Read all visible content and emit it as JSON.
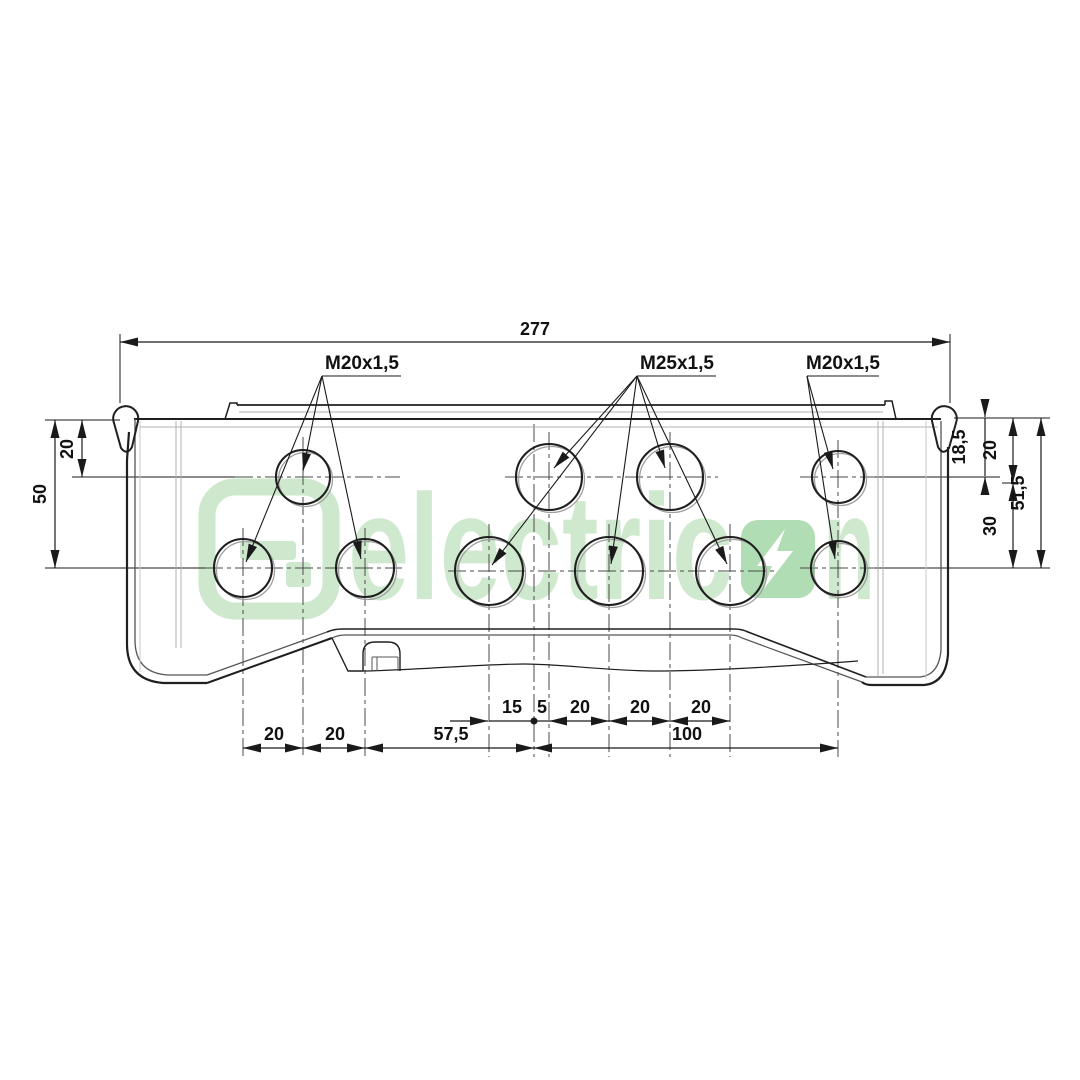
{
  "drawing": {
    "overall_width_dim": "277",
    "thread_labels": {
      "left": "M20x1,5",
      "middle": "M25x1,5",
      "right": "M20x1,5"
    },
    "left_dims": [
      "20",
      "50"
    ],
    "right_dims": [
      "18,5",
      "20",
      "30",
      "51,5"
    ],
    "bottom_upper": [
      "15",
      "5",
      "20",
      "20",
      "20"
    ],
    "bottom_lower": [
      "20",
      "20",
      "57,5",
      "100"
    ]
  },
  "watermark": {
    "word": "electric",
    "suffix": "n",
    "logo": "g-mark-logo",
    "bolt_icon": "lightning-bolt",
    "word_color": "#cfe9cf",
    "bolt_square_color": "#b0ddb3"
  },
  "colors": {
    "line_dark": "#1f1f1f",
    "line_medium": "#555555",
    "line_light": "#b0b0b0",
    "dimension": "#1a1a1a",
    "background": "#ffffff"
  }
}
